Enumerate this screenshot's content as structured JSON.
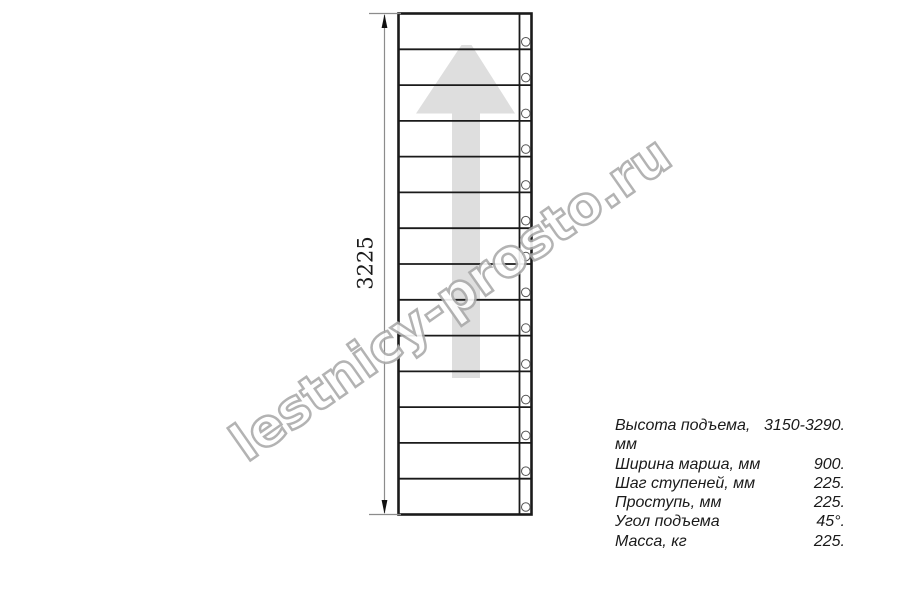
{
  "page": {
    "background": "#ffffff",
    "description_title": "Stair flight plan drawing"
  },
  "drawing": {
    "dimension_label": "3225",
    "step_count": 14,
    "fastener_count": 14
  },
  "watermark": {
    "text": "lestnicy-prosto.ru"
  },
  "specs": {
    "rows": [
      {
        "label": "Высота подъема, мм",
        "value": "3150-3290."
      },
      {
        "label": "Ширина марша, мм",
        "value": "900."
      },
      {
        "label": "Шаг ступеней, мм",
        "value": "225."
      },
      {
        "label": "Проступь, мм",
        "value": "225."
      },
      {
        "label": "Угол подъема",
        "value": "45°."
      },
      {
        "label": "Масса, кг",
        "value": "225."
      }
    ]
  },
  "colors": {
    "stair_line": "#1a1a1a",
    "dimension_line": "#8c8c8c",
    "dimension_arrow": "#111111",
    "direction_arrow_fill": "#dedede",
    "fastener_stroke": "#555555",
    "watermark_outline": "#ababab",
    "text": "#1a1a1a"
  }
}
